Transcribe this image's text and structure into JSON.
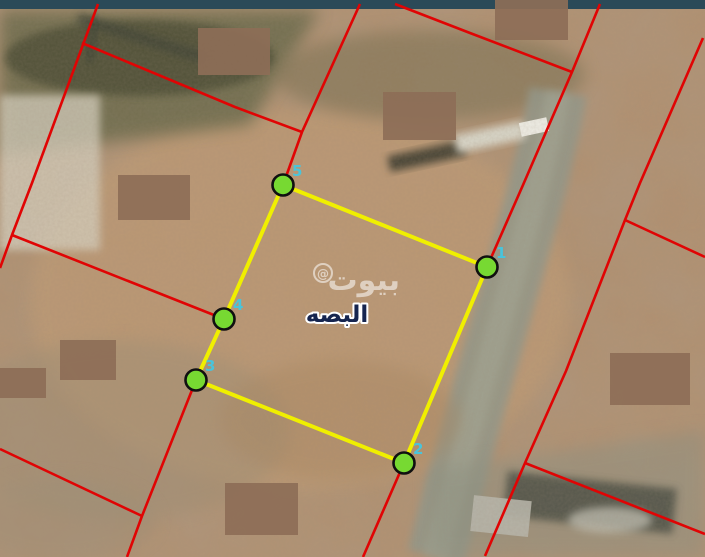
{
  "map": {
    "place_label": "البصه",
    "watermark": {
      "text": "بيوت",
      "symbol": "@"
    },
    "colors": {
      "parcel_line": "#e00404",
      "plot_outline": "#f0ef00",
      "vertex_fill": "#77d932",
      "vertex_stroke": "#101010",
      "vertex_number": "#3fc9e6",
      "place_label_fill": "#16254f",
      "place_label_halo": "#ffffff",
      "watermark_color": "#ffffff",
      "frame_band": "#2b4a58",
      "blur_patch": "#8d6e57"
    },
    "plot": {
      "vertices": [
        {
          "label": "5",
          "x": 283,
          "y": 185
        },
        {
          "label": "1",
          "x": 487,
          "y": 267
        },
        {
          "label": "2",
          "x": 404,
          "y": 463
        },
        {
          "label": "3",
          "x": 196,
          "y": 380
        },
        {
          "label": "4",
          "x": 224,
          "y": 319
        }
      ]
    },
    "parcel_lines": {
      "polylines": [
        [
          [
            98,
            4
          ],
          [
            32,
            183
          ],
          [
            12,
            235
          ],
          [
            0,
            268
          ]
        ],
        [
          [
            82,
            43
          ],
          [
            235,
            107
          ],
          [
            302,
            132
          ]
        ],
        [
          [
            360,
            4
          ],
          [
            302,
            132
          ],
          [
            283,
            185
          ]
        ],
        [
          [
            12,
            235
          ],
          [
            224,
            319
          ]
        ],
        [
          [
            196,
            380
          ],
          [
            142,
            516
          ],
          [
            127,
            557
          ]
        ],
        [
          [
            0,
            449
          ],
          [
            142,
            516
          ]
        ],
        [
          [
            395,
            4
          ],
          [
            470,
            33
          ],
          [
            572,
            72
          ]
        ],
        [
          [
            600,
            4
          ],
          [
            572,
            72
          ],
          [
            523,
            185
          ],
          [
            487,
            267
          ],
          [
            404,
            463
          ],
          [
            363,
            557
          ]
        ],
        [
          [
            703,
            38
          ],
          [
            640,
            183
          ],
          [
            625,
            220
          ],
          [
            566,
            371
          ],
          [
            525,
            463
          ],
          [
            485,
            556
          ]
        ],
        [
          [
            625,
            220
          ],
          [
            705,
            257
          ]
        ],
        [
          [
            525,
            463
          ],
          [
            705,
            534
          ]
        ]
      ]
    },
    "blur_patches": [
      {
        "x": 198,
        "y": 28,
        "w": 72,
        "h": 47
      },
      {
        "x": 383,
        "y": 92,
        "w": 73,
        "h": 48
      },
      {
        "x": 495,
        "y": 0,
        "w": 73,
        "h": 40
      },
      {
        "x": 118,
        "y": 175,
        "w": 72,
        "h": 45
      },
      {
        "x": 60,
        "y": 340,
        "w": 56,
        "h": 40
      },
      {
        "x": 0,
        "y": 368,
        "w": 46,
        "h": 30
      },
      {
        "x": 225,
        "y": 483,
        "w": 73,
        "h": 52
      },
      {
        "x": 610,
        "y": 353,
        "w": 80,
        "h": 52
      }
    ]
  }
}
